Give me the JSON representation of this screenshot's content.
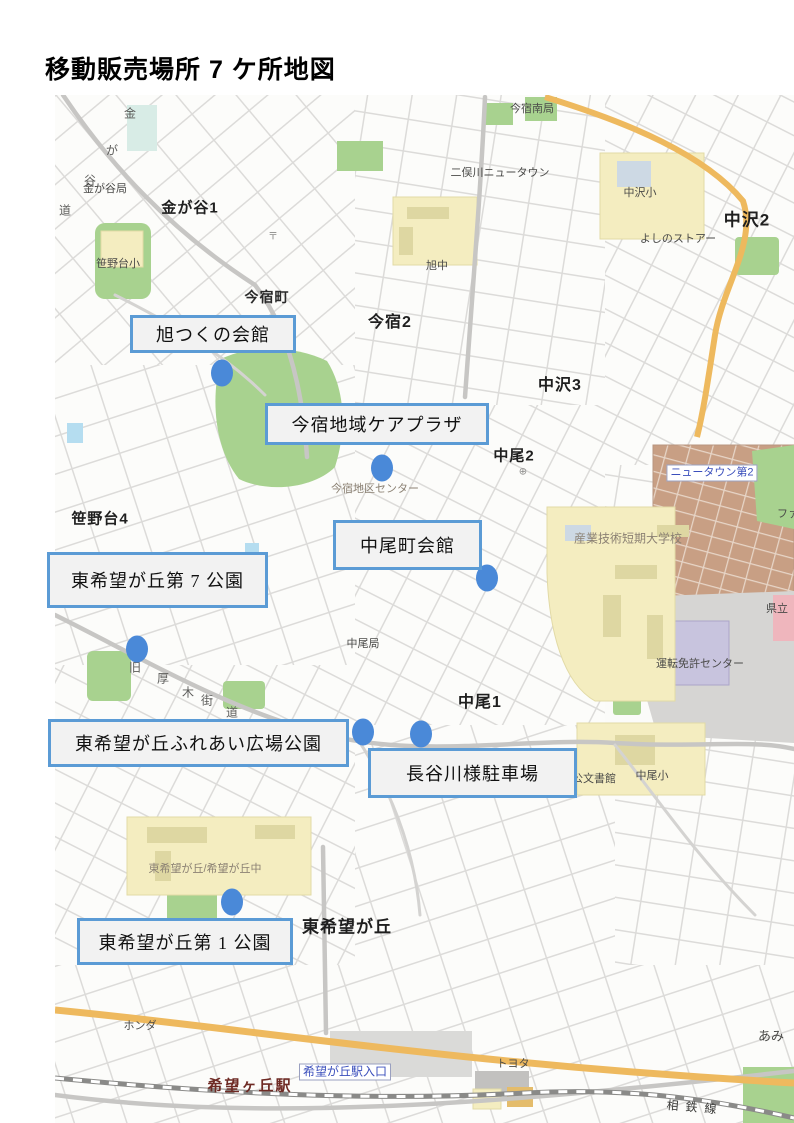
{
  "title": "移動販売場所 7 ケ所地図",
  "map": {
    "colors": {
      "marker_dot": "#4a89d8",
      "marker_border": "#5b9bd5",
      "marker_bg": "#f2f2f2"
    },
    "markers": [
      {
        "label": "旭つくの会館",
        "box": {
          "x": 75,
          "y": 220,
          "w": 166,
          "h": 38
        },
        "dot": {
          "x": 167,
          "y": 278
        }
      },
      {
        "label": "今宿地域ケアプラザ",
        "box": {
          "x": 210,
          "y": 308,
          "w": 224,
          "h": 42
        },
        "dot": {
          "x": 327,
          "y": 373
        }
      },
      {
        "label": "中尾町会館",
        "box": {
          "x": 278,
          "y": 425,
          "w": 149,
          "h": 50
        },
        "dot": {
          "x": 432,
          "y": 483
        }
      },
      {
        "label": "東希望が丘第 7 公園",
        "box": {
          "x": -8,
          "y": 457,
          "w": 221,
          "h": 56
        },
        "dot": {
          "x": 82,
          "y": 554
        }
      },
      {
        "label": "東希望が丘ふれあい広場公園",
        "box": {
          "x": -7,
          "y": 624,
          "w": 301,
          "h": 48
        },
        "dot": {
          "x": 308,
          "y": 637
        }
      },
      {
        "label": "長谷川様駐車場",
        "box": {
          "x": 313,
          "y": 653,
          "w": 209,
          "h": 50
        },
        "dot": {
          "x": 366,
          "y": 639
        }
      },
      {
        "label": "東希望が丘第 1 公園",
        "box": {
          "x": 22,
          "y": 823,
          "w": 216,
          "h": 47
        },
        "dot": {
          "x": 177,
          "y": 807
        }
      }
    ],
    "place_labels": [
      {
        "text": "金",
        "x": 75,
        "y": 18,
        "cls": "roadchar"
      },
      {
        "text": "が",
        "x": 57,
        "y": 55,
        "cls": "roadchar"
      },
      {
        "text": "谷",
        "x": 35,
        "y": 85,
        "cls": "roadchar"
      },
      {
        "text": "道",
        "x": 10,
        "y": 115,
        "cls": "roadchar"
      },
      {
        "text": "金が谷局",
        "x": 50,
        "y": 93,
        "cls": "poi"
      },
      {
        "text": "金が谷1",
        "x": 135,
        "y": 112,
        "cls": "area",
        "size": 15
      },
      {
        "text": "〒",
        "x": 218,
        "y": 140,
        "cls": "glyph"
      },
      {
        "text": "笹野台小",
        "x": 63,
        "y": 168,
        "cls": "poi"
      },
      {
        "text": "今宿町",
        "x": 212,
        "y": 202,
        "cls": "area-sm"
      },
      {
        "text": "今宿2",
        "x": 335,
        "y": 225,
        "cls": "area"
      },
      {
        "text": "旭中",
        "x": 382,
        "y": 170,
        "cls": "poi"
      },
      {
        "text": "今宿南局",
        "x": 477,
        "y": 13,
        "cls": "poi"
      },
      {
        "text": "二俣川ニュータウン",
        "x": 445,
        "y": 77,
        "cls": "poi"
      },
      {
        "text": "中沢小",
        "x": 585,
        "y": 97,
        "cls": "poi"
      },
      {
        "text": "中沢2",
        "x": 692,
        "y": 123,
        "cls": "area",
        "size": 17
      },
      {
        "text": "よしのストアー",
        "x": 623,
        "y": 143,
        "cls": "poi"
      },
      {
        "text": "中沢3",
        "x": 505,
        "y": 288,
        "cls": "area"
      },
      {
        "text": "中尾2",
        "x": 459,
        "y": 360,
        "cls": "area",
        "size": 15
      },
      {
        "text": "⊕",
        "x": 468,
        "y": 377,
        "cls": "glyph"
      },
      {
        "text": "ニュータウン第2",
        "x": 657,
        "y": 378,
        "cls": "sign"
      },
      {
        "text": "ファ",
        "x": 733,
        "y": 418,
        "cls": "poi"
      },
      {
        "text": "産業技術短期大学校",
        "x": 573,
        "y": 443,
        "cls": "poi-faded",
        "size": 12
      },
      {
        "text": "笹野台4",
        "x": 45,
        "y": 423,
        "cls": "area",
        "size": 15
      },
      {
        "text": "今宿地区センター",
        "x": 320,
        "y": 393,
        "cls": "poi-faded"
      },
      {
        "text": "県立",
        "x": 722,
        "y": 513,
        "cls": "poi"
      },
      {
        "text": "中尾局",
        "x": 308,
        "y": 548,
        "cls": "poi"
      },
      {
        "text": "運転免許センター",
        "x": 645,
        "y": 568,
        "cls": "poi"
      },
      {
        "text": "中尾1",
        "x": 425,
        "y": 605,
        "cls": "area"
      },
      {
        "text": "旧",
        "x": 80,
        "y": 572,
        "cls": "roadchar"
      },
      {
        "text": "厚",
        "x": 108,
        "y": 583,
        "cls": "roadchar"
      },
      {
        "text": "木",
        "x": 133,
        "y": 597,
        "cls": "roadchar"
      },
      {
        "text": "街",
        "x": 152,
        "y": 605,
        "cls": "roadchar"
      },
      {
        "text": "道",
        "x": 177,
        "y": 617,
        "cls": "roadchar"
      },
      {
        "text": "公文書館",
        "x": 539,
        "y": 683,
        "cls": "poi"
      },
      {
        "text": "中尾小",
        "x": 597,
        "y": 680,
        "cls": "poi"
      },
      {
        "text": "東希望が丘/希望が丘中",
        "x": 150,
        "y": 773,
        "cls": "poi-faded"
      },
      {
        "text": "東希望が丘",
        "x": 292,
        "y": 830,
        "cls": "area",
        "size": 17
      },
      {
        "text": "ホンダ",
        "x": 85,
        "y": 930,
        "cls": "poi"
      },
      {
        "text": "希望ヶ丘駅",
        "x": 195,
        "y": 990,
        "cls": "station"
      },
      {
        "text": "希望が丘駅入口",
        "x": 290,
        "y": 977,
        "cls": "sign",
        "size": 12
      },
      {
        "text": "トヨタ",
        "x": 458,
        "y": 968,
        "cls": "poi"
      },
      {
        "text": "あみ",
        "x": 716,
        "y": 940,
        "cls": "poi",
        "size": 13
      },
      {
        "text": "相鉄線",
        "x": 640,
        "y": 1012,
        "cls": "rail",
        "rot": 5
      }
    ]
  }
}
